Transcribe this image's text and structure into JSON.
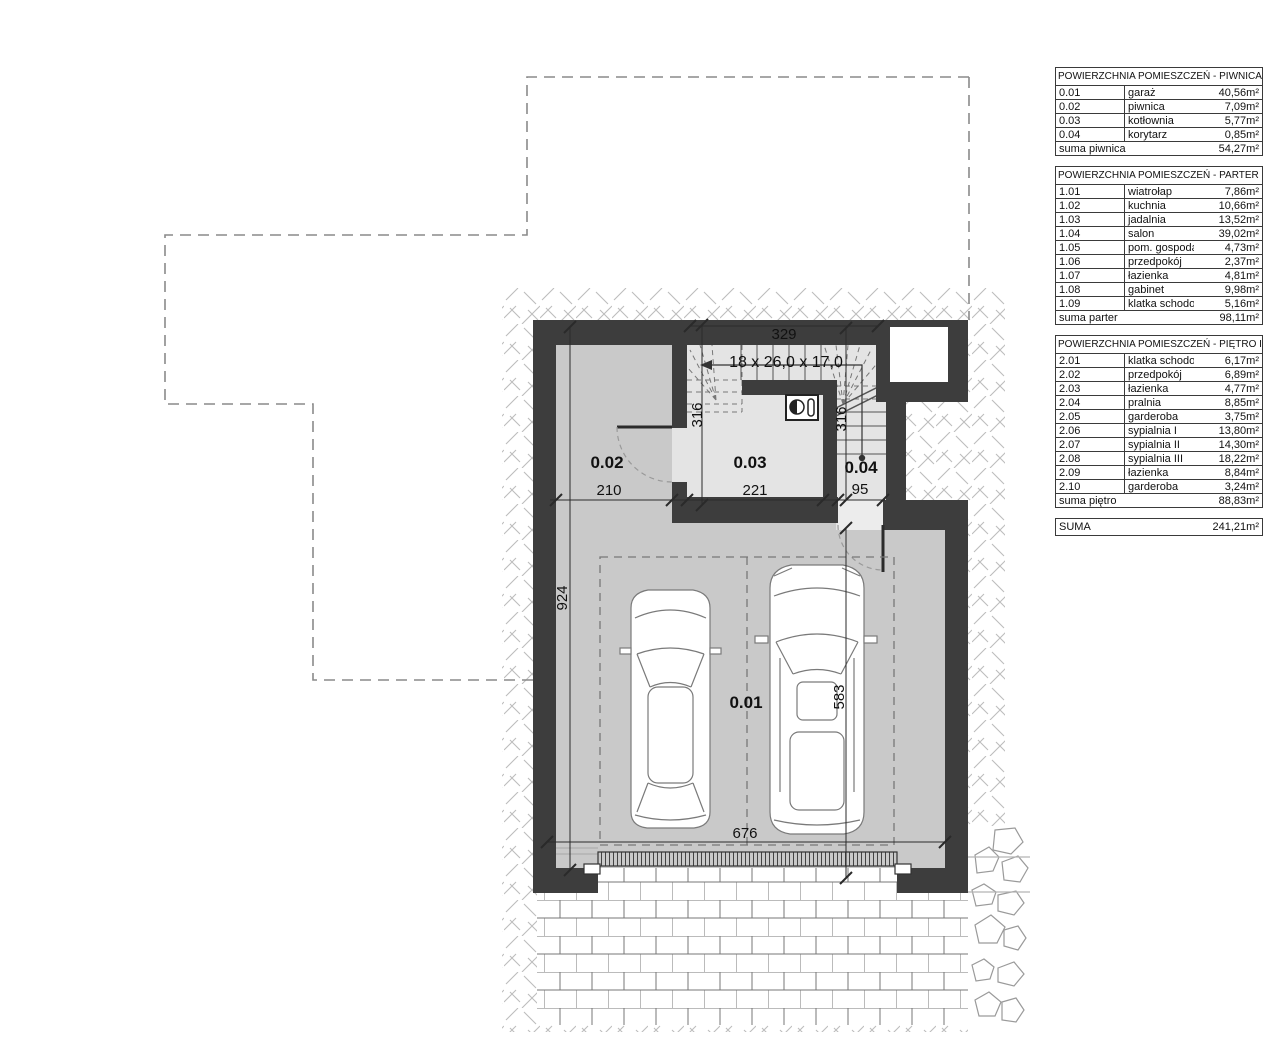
{
  "plan": {
    "labels": {
      "room_0_01": "0.01",
      "room_0_02": "0.02",
      "room_0_03": "0.03",
      "room_0_04": "0.04",
      "stair_spec": "18 x 26,0 x 17,0",
      "dim_329": "329",
      "dim_316_left": "316",
      "dim_316_right": "316",
      "dim_210": "210",
      "dim_221": "221",
      "dim_95": "95",
      "dim_924": "924",
      "dim_583": "583",
      "dim_676": "676"
    }
  },
  "tables": [
    {
      "id": "piwnica",
      "title": "POWIERZCHNIA POMIESZCZEŃ - PIWNICA",
      "rows": [
        [
          "0.01",
          "garaż",
          "40,56m²"
        ],
        [
          "0.02",
          "piwnica",
          "7,09m²"
        ],
        [
          "0.03",
          "kotłownia",
          "5,77m²"
        ],
        [
          "0.04",
          "korytarz",
          "0,85m²"
        ]
      ],
      "footer": [
        "suma piwnica",
        "54,27m²"
      ]
    },
    {
      "id": "parter",
      "title": "POWIERZCHNIA POMIESZCZEŃ - PARTER",
      "rows": [
        [
          "1.01",
          "wiatrołap",
          "7,86m²"
        ],
        [
          "1.02",
          "kuchnia",
          "10,66m²"
        ],
        [
          "1.03",
          "jadalnia",
          "13,52m²"
        ],
        [
          "1.04",
          "salon",
          "39,02m²"
        ],
        [
          "1.05",
          "pom. gospodarcze",
          "4,73m²"
        ],
        [
          "1.06",
          "przedpokój",
          "2,37m²"
        ],
        [
          "1.07",
          "łazienka",
          "4,81m²"
        ],
        [
          "1.08",
          "gabinet",
          "9,98m²"
        ],
        [
          "1.09",
          "klatka schodowa",
          "5,16m²"
        ]
      ],
      "footer": [
        "suma parter",
        "98,11m²"
      ]
    },
    {
      "id": "pietro",
      "title": "POWIERZCHNIA POMIESZCZEŃ - PIĘTRO I",
      "rows": [
        [
          "2.01",
          "klatka schodowa",
          "6,17m²"
        ],
        [
          "2.02",
          "przedpokój",
          "6,89m²"
        ],
        [
          "2.03",
          "łazienka",
          "4,77m²"
        ],
        [
          "2.04",
          "pralnia",
          "8,85m²"
        ],
        [
          "2.05",
          "garderoba",
          "3,75m²"
        ],
        [
          "2.06",
          "sypialnia I",
          "13,80m²"
        ],
        [
          "2.07",
          "sypialnia II",
          "14,30m²"
        ],
        [
          "2.08",
          "sypialnia III",
          "18,22m²"
        ],
        [
          "2.09",
          "łazienka",
          "8,84m²"
        ],
        [
          "2.10",
          "garderoba",
          "3,24m²"
        ]
      ],
      "footer": [
        "suma piętro",
        "88,83m²"
      ]
    }
  ],
  "total": {
    "label": "SUMA",
    "value": "241,21m²"
  },
  "colors": {
    "wall": "#3d3d3d",
    "floor": "#c9c9c9",
    "floor_light": "#e4e4e4",
    "hatch_line": "#bdbdbd",
    "dashed_outline": "#8a8a8a",
    "text": "#111111"
  }
}
